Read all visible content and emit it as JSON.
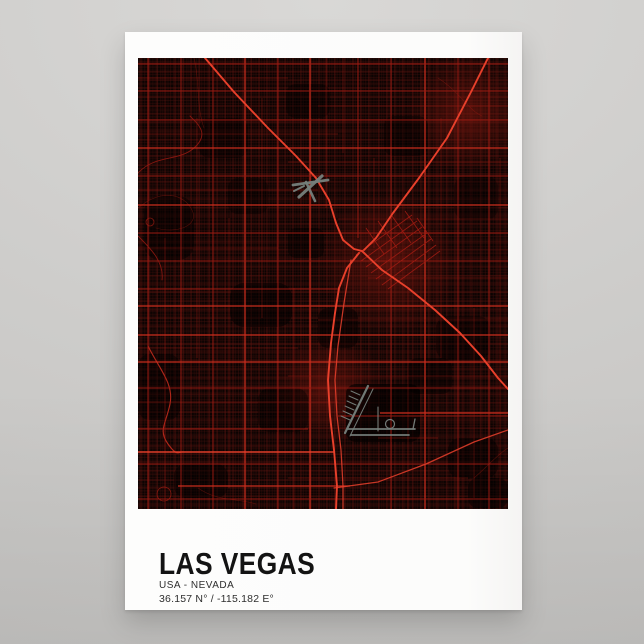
{
  "scene": {
    "background_top": "#d9d8d6",
    "background_bottom": "#c4c3c1"
  },
  "poster": {
    "title": "LAS VEGAS",
    "subtitle": "USA - NEVADA",
    "coordinates": "36.157 N° / -115.182 E°",
    "paper_color": "#fdfdfc",
    "text_color": "#161616"
  },
  "map": {
    "width": 370,
    "height": 451,
    "background": "#0b0302",
    "colors": {
      "minor": "#44100b",
      "medium": "#701510",
      "arterial": "#9e1b12",
      "bright": "#c92d1d",
      "highway": "#e8402b",
      "glow": "#8a1a10",
      "airport": "#76807c"
    },
    "fine_grid": {
      "tile": 13,
      "vx": [
        1.2,
        4.1,
        6.8,
        9.7,
        11.9
      ],
      "hy": [
        0.8,
        3.6,
        6.5,
        9.2,
        12.1
      ],
      "sw": 0.3,
      "opacity": 0.9
    },
    "fine_grid_2": {
      "tile": 17,
      "vx": [
        2,
        7,
        12,
        15.5
      ],
      "hy": [
        3,
        8.5,
        13.5
      ],
      "sw": 0.3,
      "opacity": 0.5
    },
    "medium_grid": {
      "tile": 34,
      "vx": [
        3,
        11,
        19,
        27
      ],
      "hy": [
        5,
        14,
        22,
        30
      ],
      "sw": 0.55,
      "opacity": 0.8
    },
    "glows": [
      [
        250,
        205,
        70
      ],
      [
        330,
        55,
        60
      ],
      [
        190,
        330,
        55
      ]
    ],
    "dark_patches": [
      [
        92,
        225,
        62,
        44,
        0.5,
        14
      ],
      [
        6,
        138,
        50,
        64,
        0.45,
        16
      ],
      [
        208,
        326,
        74,
        58,
        0.62,
        10
      ],
      [
        148,
        26,
        44,
        34,
        0.4,
        10
      ],
      [
        298,
        258,
        54,
        44,
        0.4,
        12
      ],
      [
        36,
        406,
        54,
        34,
        0.45,
        12
      ],
      [
        246,
        58,
        44,
        40,
        0.38,
        10
      ],
      [
        0,
        296,
        42,
        66,
        0.42,
        12
      ],
      [
        316,
        118,
        44,
        44,
        0.32,
        12
      ],
      [
        60,
        60,
        50,
        40,
        0.35,
        12
      ],
      [
        180,
        250,
        40,
        40,
        0.45,
        10
      ],
      [
        120,
        330,
        50,
        44,
        0.4,
        12
      ],
      [
        270,
        300,
        44,
        36,
        0.4,
        10
      ],
      [
        90,
        120,
        40,
        36,
        0.35,
        10
      ],
      [
        310,
        380,
        50,
        40,
        0.45,
        12
      ],
      [
        150,
        170,
        36,
        30,
        0.4,
        8
      ],
      [
        330,
        420,
        40,
        30,
        0.5,
        10
      ]
    ],
    "vertical_roads": [
      [
        10,
        0,
        451,
        "a"
      ],
      [
        27,
        180,
        451,
        "a2"
      ],
      [
        43,
        0,
        451,
        "a"
      ],
      [
        59,
        60,
        300,
        "a2"
      ],
      [
        75,
        0,
        451,
        "a"
      ],
      [
        91,
        160,
        430,
        "a2"
      ],
      [
        107,
        0,
        451,
        "b"
      ],
      [
        124,
        40,
        260,
        "a2"
      ],
      [
        140,
        0,
        451,
        "a"
      ],
      [
        156,
        230,
        451,
        "a2"
      ],
      [
        172,
        0,
        451,
        "b"
      ],
      [
        188,
        0,
        150,
        "a2"
      ],
      [
        205,
        0,
        95,
        "a2"
      ],
      [
        220,
        0,
        180,
        "a"
      ],
      [
        236,
        100,
        190,
        "a2"
      ],
      [
        253,
        0,
        451,
        "a"
      ],
      [
        270,
        230,
        451,
        "a2"
      ],
      [
        287,
        0,
        451,
        "b"
      ],
      [
        303,
        60,
        300,
        "a2"
      ],
      [
        320,
        0,
        451,
        "a"
      ],
      [
        336,
        250,
        440,
        "a2"
      ],
      [
        351,
        0,
        451,
        "a"
      ],
      [
        362,
        100,
        451,
        "a2"
      ]
    ],
    "horizontal_roads": [
      [
        6,
        0,
        370,
        "a"
      ],
      [
        20,
        0,
        150,
        "a2"
      ],
      [
        33,
        0,
        370,
        "a"
      ],
      [
        48,
        180,
        370,
        "a2"
      ],
      [
        62,
        0,
        370,
        "a"
      ],
      [
        76,
        0,
        200,
        "a2"
      ],
      [
        90,
        0,
        370,
        "b"
      ],
      [
        104,
        150,
        370,
        "a2"
      ],
      [
        118,
        0,
        370,
        "a"
      ],
      [
        132,
        0,
        180,
        "a2"
      ],
      [
        147,
        0,
        370,
        "b"
      ],
      [
        161,
        200,
        370,
        "a2"
      ],
      [
        175,
        0,
        370,
        "a"
      ],
      [
        190,
        0,
        140,
        "a2"
      ],
      [
        203,
        0,
        370,
        "a"
      ],
      [
        220,
        230,
        370,
        "a2"
      ],
      [
        231,
        0,
        200,
        "a"
      ],
      [
        248,
        0,
        370,
        "b"
      ],
      [
        262,
        180,
        370,
        "a2"
      ],
      [
        277,
        0,
        370,
        "b"
      ],
      [
        290,
        0,
        160,
        "a2"
      ],
      [
        304,
        0,
        370,
        "b"
      ],
      [
        318,
        150,
        370,
        "a2"
      ],
      [
        330,
        0,
        370,
        "a"
      ],
      [
        344,
        0,
        200,
        "a2"
      ],
      [
        355,
        242,
        370,
        "b"
      ],
      [
        358,
        200,
        370,
        "a"
      ],
      [
        371,
        0,
        170,
        "a"
      ],
      [
        380,
        240,
        300,
        "a2"
      ],
      [
        394,
        0,
        196,
        "hb"
      ],
      [
        406,
        0,
        370,
        "a"
      ],
      [
        420,
        150,
        330,
        "a2"
      ],
      [
        428,
        40,
        212,
        "b"
      ],
      [
        441,
        0,
        370,
        "a"
      ]
    ],
    "curves": [
      {
        "d": "M0,115 C18,96 40,104 56,90 S60,66 52,58",
        "tier": "a"
      },
      {
        "d": "M0,150 C24,130 46,136 54,152 S38,176 18,170",
        "tier": "a2"
      },
      {
        "d": "M0,178 C14,192 26,204 24,222",
        "tier": "a"
      },
      {
        "d": "M10,288 C22,312 36,326 32,346 S20,372 30,386 S40,393 46,394",
        "tier": "b"
      },
      {
        "d": "M56,0 C62,24 58,48 66,70",
        "tier": "a2"
      },
      {
        "d": "M300,20 C322,34 330,52 344,58",
        "tier": "a2"
      },
      {
        "d": "M336,420 C350,408 360,396 370,390",
        "tier": "a2"
      },
      {
        "d": "M60,430 C80,444 100,440 118,446",
        "tier": "a2"
      }
    ],
    "circles": [
      [
        12,
        164,
        4
      ],
      [
        26,
        436,
        7
      ]
    ],
    "downtown_grid": [
      [
        218,
        197,
        274,
        157
      ],
      [
        223,
        203,
        279,
        163
      ],
      [
        228,
        209,
        284,
        169
      ],
      [
        233,
        215,
        289,
        175
      ],
      [
        238,
        221,
        293,
        181
      ],
      [
        244,
        227,
        298,
        187
      ],
      [
        250,
        231,
        302,
        193
      ],
      [
        240,
        163,
        259,
        190
      ],
      [
        254,
        158,
        273,
        185
      ],
      [
        267,
        153,
        286,
        180
      ],
      [
        228,
        170,
        246,
        196
      ],
      [
        279,
        160,
        295,
        183
      ]
    ],
    "highways": [
      {
        "name": "us-95-northwest",
        "tier": "h",
        "points": [
          [
            67,
            0
          ],
          [
            96,
            34
          ],
          [
            130,
            70
          ],
          [
            158,
            98
          ],
          [
            178,
            120
          ],
          [
            191,
            142
          ],
          [
            198,
            165
          ],
          [
            205,
            182
          ],
          [
            216,
            191
          ],
          [
            224,
            193
          ]
        ]
      },
      {
        "name": "i-515-north",
        "tier": "h",
        "points": [
          [
            350,
            0
          ],
          [
            333,
            34
          ],
          [
            309,
            80
          ],
          [
            281,
            120
          ],
          [
            255,
            155
          ],
          [
            238,
            180
          ],
          [
            226,
            192
          ]
        ]
      },
      {
        "name": "i-515-southeast",
        "tier": "h",
        "points": [
          [
            224,
            193
          ],
          [
            244,
            212
          ],
          [
            270,
            230
          ],
          [
            297,
            252
          ],
          [
            322,
            275
          ],
          [
            343,
            298
          ],
          [
            360,
            320
          ],
          [
            370,
            331
          ]
        ]
      },
      {
        "name": "i-15-south",
        "tier": "h",
        "points": [
          [
            221,
            195
          ],
          [
            209,
            210
          ],
          [
            201,
            230
          ],
          [
            197,
            255
          ],
          [
            193,
            285
          ],
          [
            190,
            322
          ],
          [
            192,
            358
          ],
          [
            196,
            392
          ],
          [
            199,
            428
          ],
          [
            198,
            451
          ]
        ]
      },
      {
        "name": "las-vegas-blvd",
        "tier": "h2",
        "points": [
          [
            213,
            202
          ],
          [
            206,
            245
          ],
          [
            200,
            288
          ],
          [
            197,
            322
          ],
          [
            199,
            358
          ],
          [
            203,
            392
          ],
          [
            205,
            428
          ],
          [
            205,
            451
          ]
        ]
      },
      {
        "name": "airport-connector",
        "tier": "h2",
        "points": [
          [
            196,
            430
          ],
          [
            240,
            424
          ],
          [
            288,
            406
          ],
          [
            336,
            384
          ],
          [
            370,
            372
          ]
        ]
      }
    ],
    "airports": [
      {
        "name": "north-las-vegas-airport",
        "segments": [
          [
            155,
            127,
            190,
            122,
            2.8
          ],
          [
            184,
            118,
            161,
            139,
            3.2
          ],
          [
            168,
            124,
            177,
            143,
            2.6
          ],
          [
            156,
            133,
            166,
            128,
            2
          ]
        ],
        "circles": []
      },
      {
        "name": "harry-reid-international-airport",
        "segments": [
          [
            230,
            328,
            207,
            375,
            2.2
          ],
          [
            235,
            331,
            212,
            378,
            1
          ],
          [
            210,
            371,
            277,
            371,
            1.7
          ],
          [
            213,
            377,
            271,
            377,
            1.7
          ],
          [
            275,
            371,
            277,
            361,
            1.3
          ],
          [
            240,
            349,
            240,
            373,
            1.1
          ],
          [
            222,
            337,
            213,
            333,
            1
          ],
          [
            220,
            342,
            211,
            338,
            1
          ],
          [
            218,
            347,
            209,
            343,
            1
          ],
          [
            216,
            352,
            207,
            348,
            1
          ],
          [
            214,
            357,
            205,
            353,
            1
          ],
          [
            212,
            362,
            203,
            358,
            1
          ]
        ],
        "circles": [
          [
            252,
            366,
            4.5
          ]
        ]
      }
    ]
  }
}
